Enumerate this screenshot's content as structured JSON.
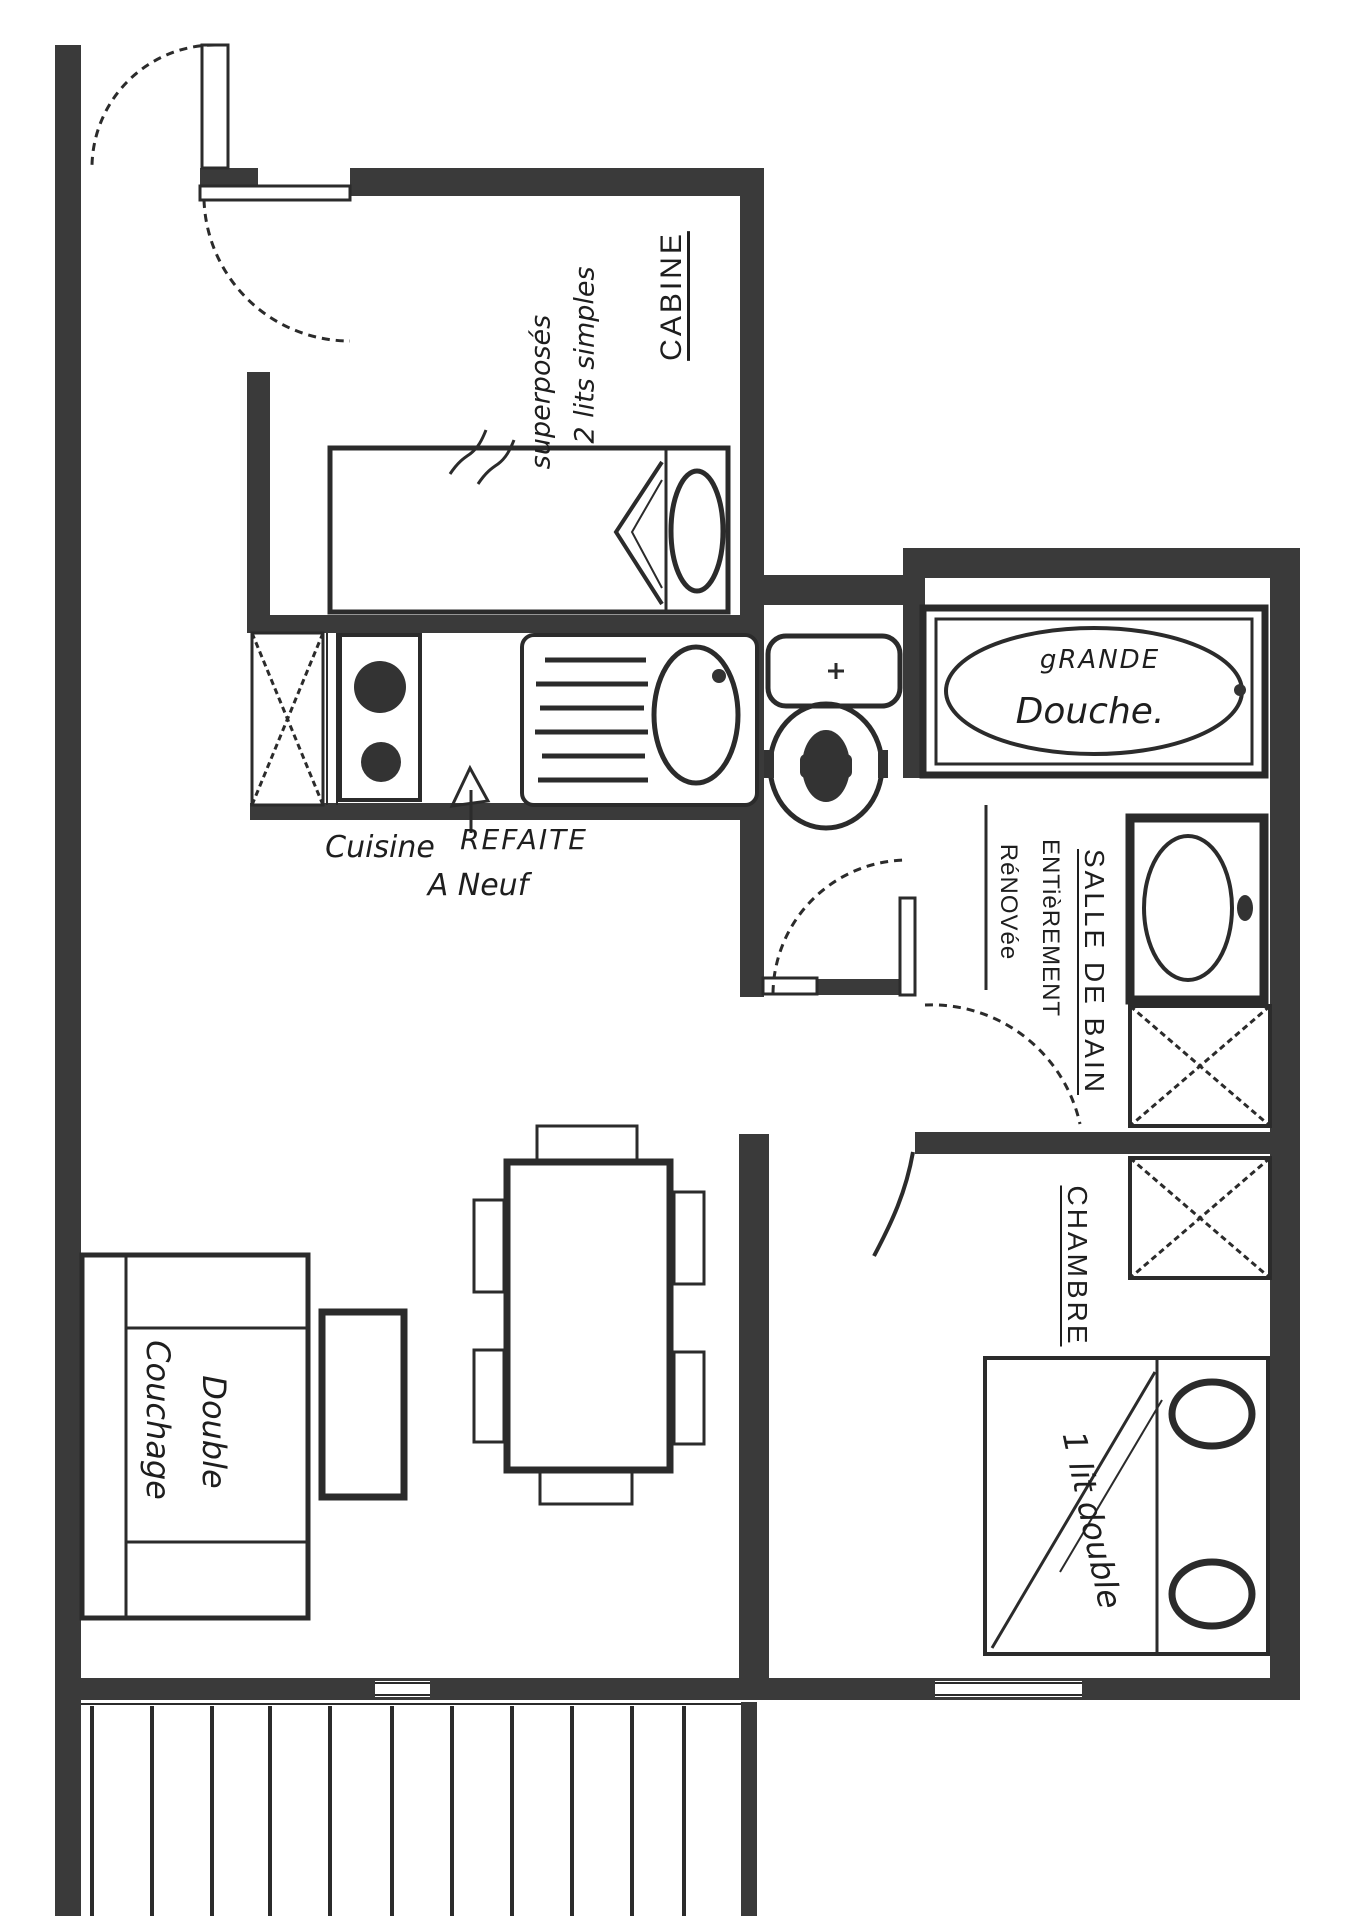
{
  "document": {
    "type": "hand-drawn apartment floor plan (scanned sketch)",
    "background": "#ffffff"
  },
  "colors": {
    "wall": "#3a3a3a",
    "line": "#2b2b2b",
    "ink": "#1e1e1e"
  },
  "labels": {
    "cabine_room": "CABINE",
    "cabine_beds_line1": "2 lits simples",
    "cabine_beds_line2": "superposés",
    "kitchen_word1": "Cuisine",
    "kitchen_word2": "REFAITE",
    "kitchen_line2": "A Neuf",
    "shower_line1": "gRANDE",
    "shower_line2": "Douche.",
    "bathroom_line1": "SALLE DE BAIN",
    "bathroom_line2": "ENTièREMENT",
    "bathroom_line3": "RéNOVée",
    "bedroom_room": "CHAMBRE",
    "bedroom_bed": "1 lit double",
    "sofa_line1": "Couchage",
    "sofa_line2": "Double"
  }
}
